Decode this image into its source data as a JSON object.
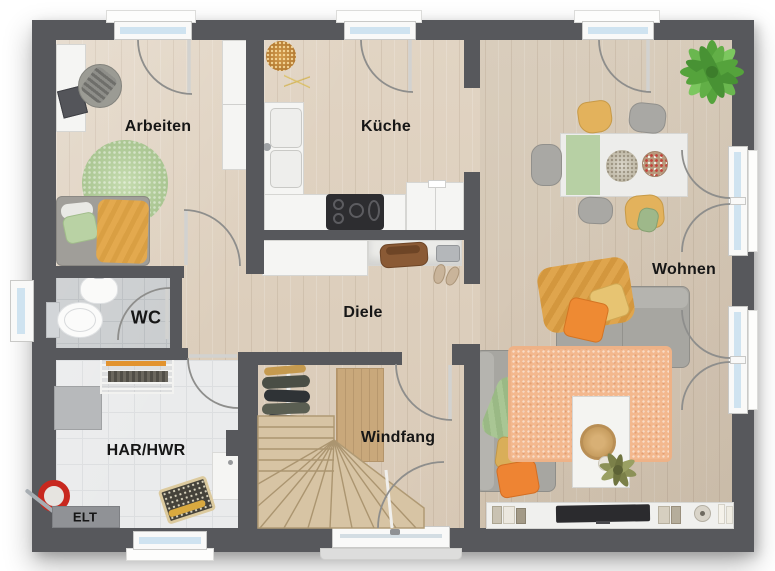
{
  "floorplan": {
    "type": "residential-ground-floor-plan",
    "labels": {
      "arbeiten": "Arbeiten",
      "kueche": "Küche",
      "wohnen": "Wohnen",
      "wc": "WC",
      "diele": "Diele",
      "har_hwr": "HAR/HWR",
      "windfang": "Windfang",
      "elt": "ELT"
    },
    "rooms": [
      {
        "key": "arbeiten",
        "label": "Arbeiten",
        "furniture": [
          "desk",
          "office-chair",
          "wardrobe",
          "bed",
          "round-rug"
        ]
      },
      {
        "key": "kueche",
        "label": "Küche",
        "furniture": [
          "l-shaped-counter",
          "double-sink",
          "cooktop",
          "tall-cabinet",
          "bread-basket"
        ]
      },
      {
        "key": "wohnen",
        "label": "Wohnen",
        "furniture": [
          "dining-table",
          "chairs",
          "potted-plant",
          "corner-sofa",
          "rug",
          "coffee-table",
          "tv-lowboard"
        ]
      },
      {
        "key": "wc",
        "label": "WC",
        "furniture": [
          "hand-basin",
          "toilet"
        ]
      },
      {
        "key": "diele",
        "label": "Diele",
        "furniture": [
          "sideboard",
          "bag",
          "shoes"
        ]
      },
      {
        "key": "har_hwr",
        "label": "HAR/HWR",
        "furniture": [
          "water-heater",
          "drying-rack",
          "appliance",
          "laundry-basket",
          "mop-bucket",
          "electrical-panel"
        ]
      },
      {
        "key": "windfang",
        "label": "Windfang",
        "furniture": [
          "staircase",
          "coat-rack",
          "doormat",
          "entrance-door"
        ]
      }
    ],
    "colors": {
      "wall": "#57585c",
      "wood_floor": "#dccdb9",
      "tile_floor_utility": "#eaebec",
      "tile_floor_wc": "#c9ccce",
      "window_glass": "#cfe3f0",
      "accent_orange": "#ee8a33",
      "accent_yellow": "#e3b25c",
      "accent_green": "#a9c493",
      "rug_salmon": "#f3b88e",
      "rug_green": "#b6cf9e",
      "plant_green": "#55a33c"
    }
  }
}
